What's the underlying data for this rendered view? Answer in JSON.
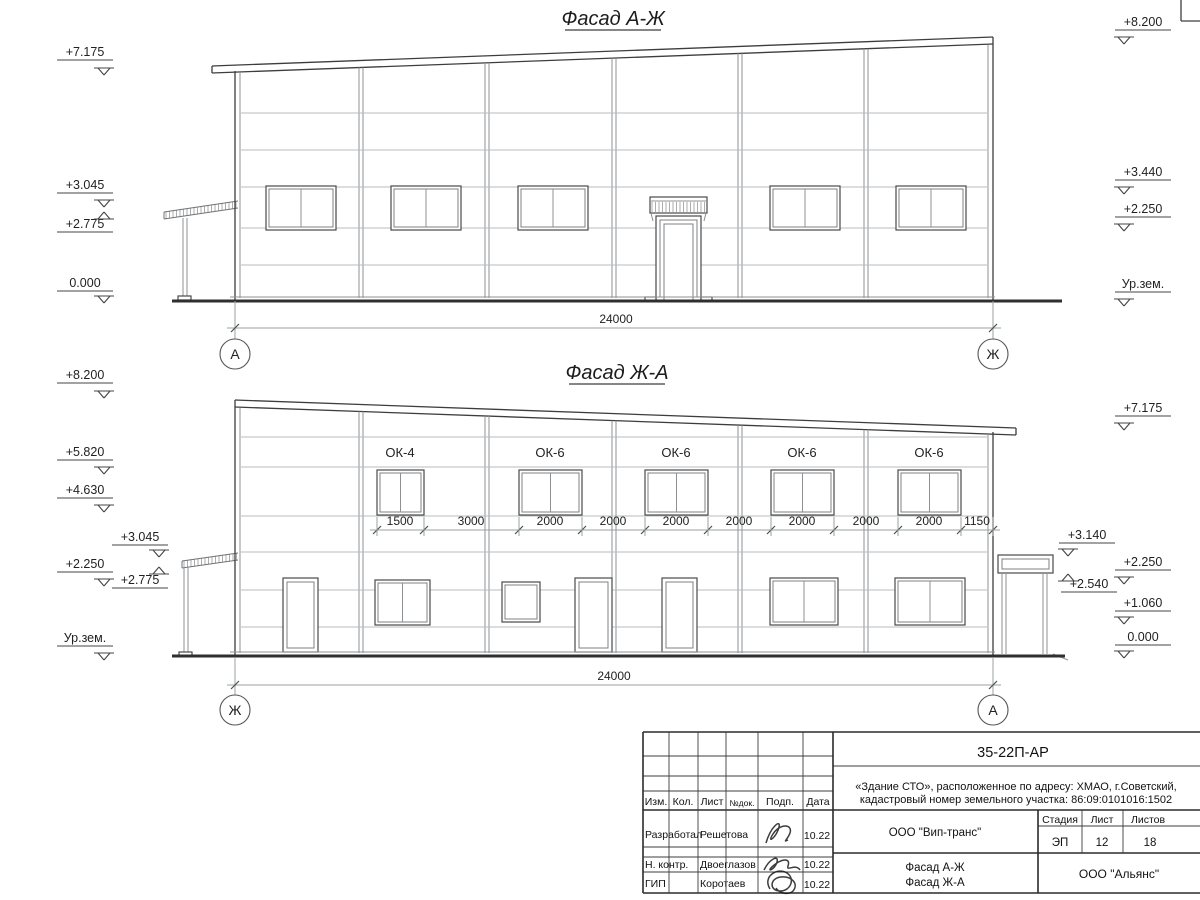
{
  "drawing": {
    "facade_top": {
      "title": "Фасад А-Ж",
      "axis_left": "А",
      "axis_right": "Ж",
      "dim_total": "24000",
      "marks_left": [
        "+7.175",
        "+3.045",
        "+2.775",
        "0.000"
      ],
      "marks_right": [
        "+8.200",
        "+3.440",
        "+2.250",
        "Ур.зем."
      ]
    },
    "facade_bottom": {
      "title": "Фасад Ж-А",
      "axis_left": "Ж",
      "axis_right": "А",
      "dim_total": "24000",
      "window_labels": [
        "ОК-4",
        "ОК-6",
        "ОК-6",
        "ОК-6",
        "ОК-6"
      ],
      "dims": [
        "1500",
        "3000",
        "2000",
        "2000",
        "2000",
        "2000",
        "2000",
        "2000",
        "2000",
        "1150"
      ],
      "marks_left": [
        "+8.200",
        "+5.820",
        "+4.630",
        "+2.250",
        "Ур.зем."
      ],
      "marks_left_inner": [
        "+3.045",
        "+2.775"
      ],
      "marks_right": [
        "+7.175",
        "+2.250",
        "+1.060",
        "0.000"
      ],
      "marks_right_inner": [
        "+3.140",
        "+2.540"
      ]
    }
  },
  "title_block": {
    "doc_number": "35-22П-АР",
    "object_line1": "«Здание СТО», расположенное по адресу: ХМАО, г.Советский,",
    "object_line2": "кадастровый номер земельного участка: 86:09:0101016:1502",
    "columns": [
      "Изм.",
      "Кол.",
      "Лист",
      "№док.",
      "Подп.",
      "Дата"
    ],
    "rows": [
      {
        "role": "Разработал",
        "name": "Решетова",
        "date": "10.22"
      },
      {
        "role": "Н. контр.",
        "name": "Двоеглазов",
        "date": "10.22"
      },
      {
        "role": "ГИП",
        "name": "Коротаев",
        "date": "10.22"
      }
    ],
    "client": "ООО \"Вип-транс\"",
    "stage_label": "Стадия",
    "sheet_label": "Лист",
    "sheets_label": "Листов",
    "stage": "ЭП",
    "sheet": "12",
    "sheets": "18",
    "sheet_title_line1": "Фасад А-Ж",
    "sheet_title_line2": "Фасад Ж-А",
    "org": "ООО \"Альянс\""
  }
}
